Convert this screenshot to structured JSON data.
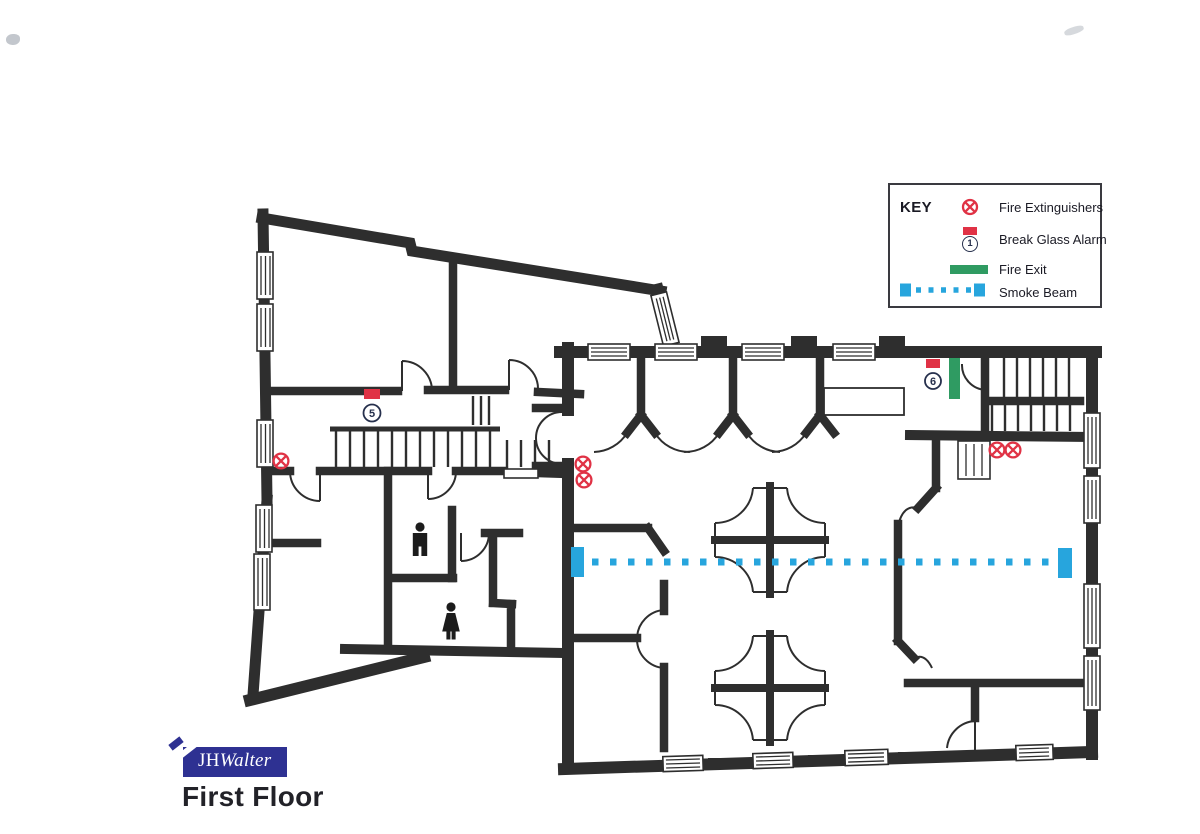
{
  "legend": {
    "title": "KEY",
    "items": [
      {
        "icon": "fire-extinguisher-icon",
        "label": "Fire Extinguishers"
      },
      {
        "icon": "break-glass-alarm-icon",
        "label": "Break Glass Alarm",
        "number": "1"
      },
      {
        "icon": "fire-exit-icon",
        "label": "Fire Exit"
      },
      {
        "icon": "smoke-beam-icon",
        "label": "Smoke Beam"
      }
    ]
  },
  "plan": {
    "break_glass_alarms": [
      {
        "number": "5"
      },
      {
        "number": "6"
      }
    ]
  },
  "footer": {
    "logo_jh": "JH",
    "logo_walter": "Walter",
    "floor_title": "First Floor"
  },
  "colors": {
    "wall": "#2e2e2e",
    "red": "#e03245",
    "green": "#2f9b62",
    "blue": "#27a5dd",
    "navy": "#2e3192",
    "ink": "#1a1a24",
    "ring": "#26304d"
  }
}
